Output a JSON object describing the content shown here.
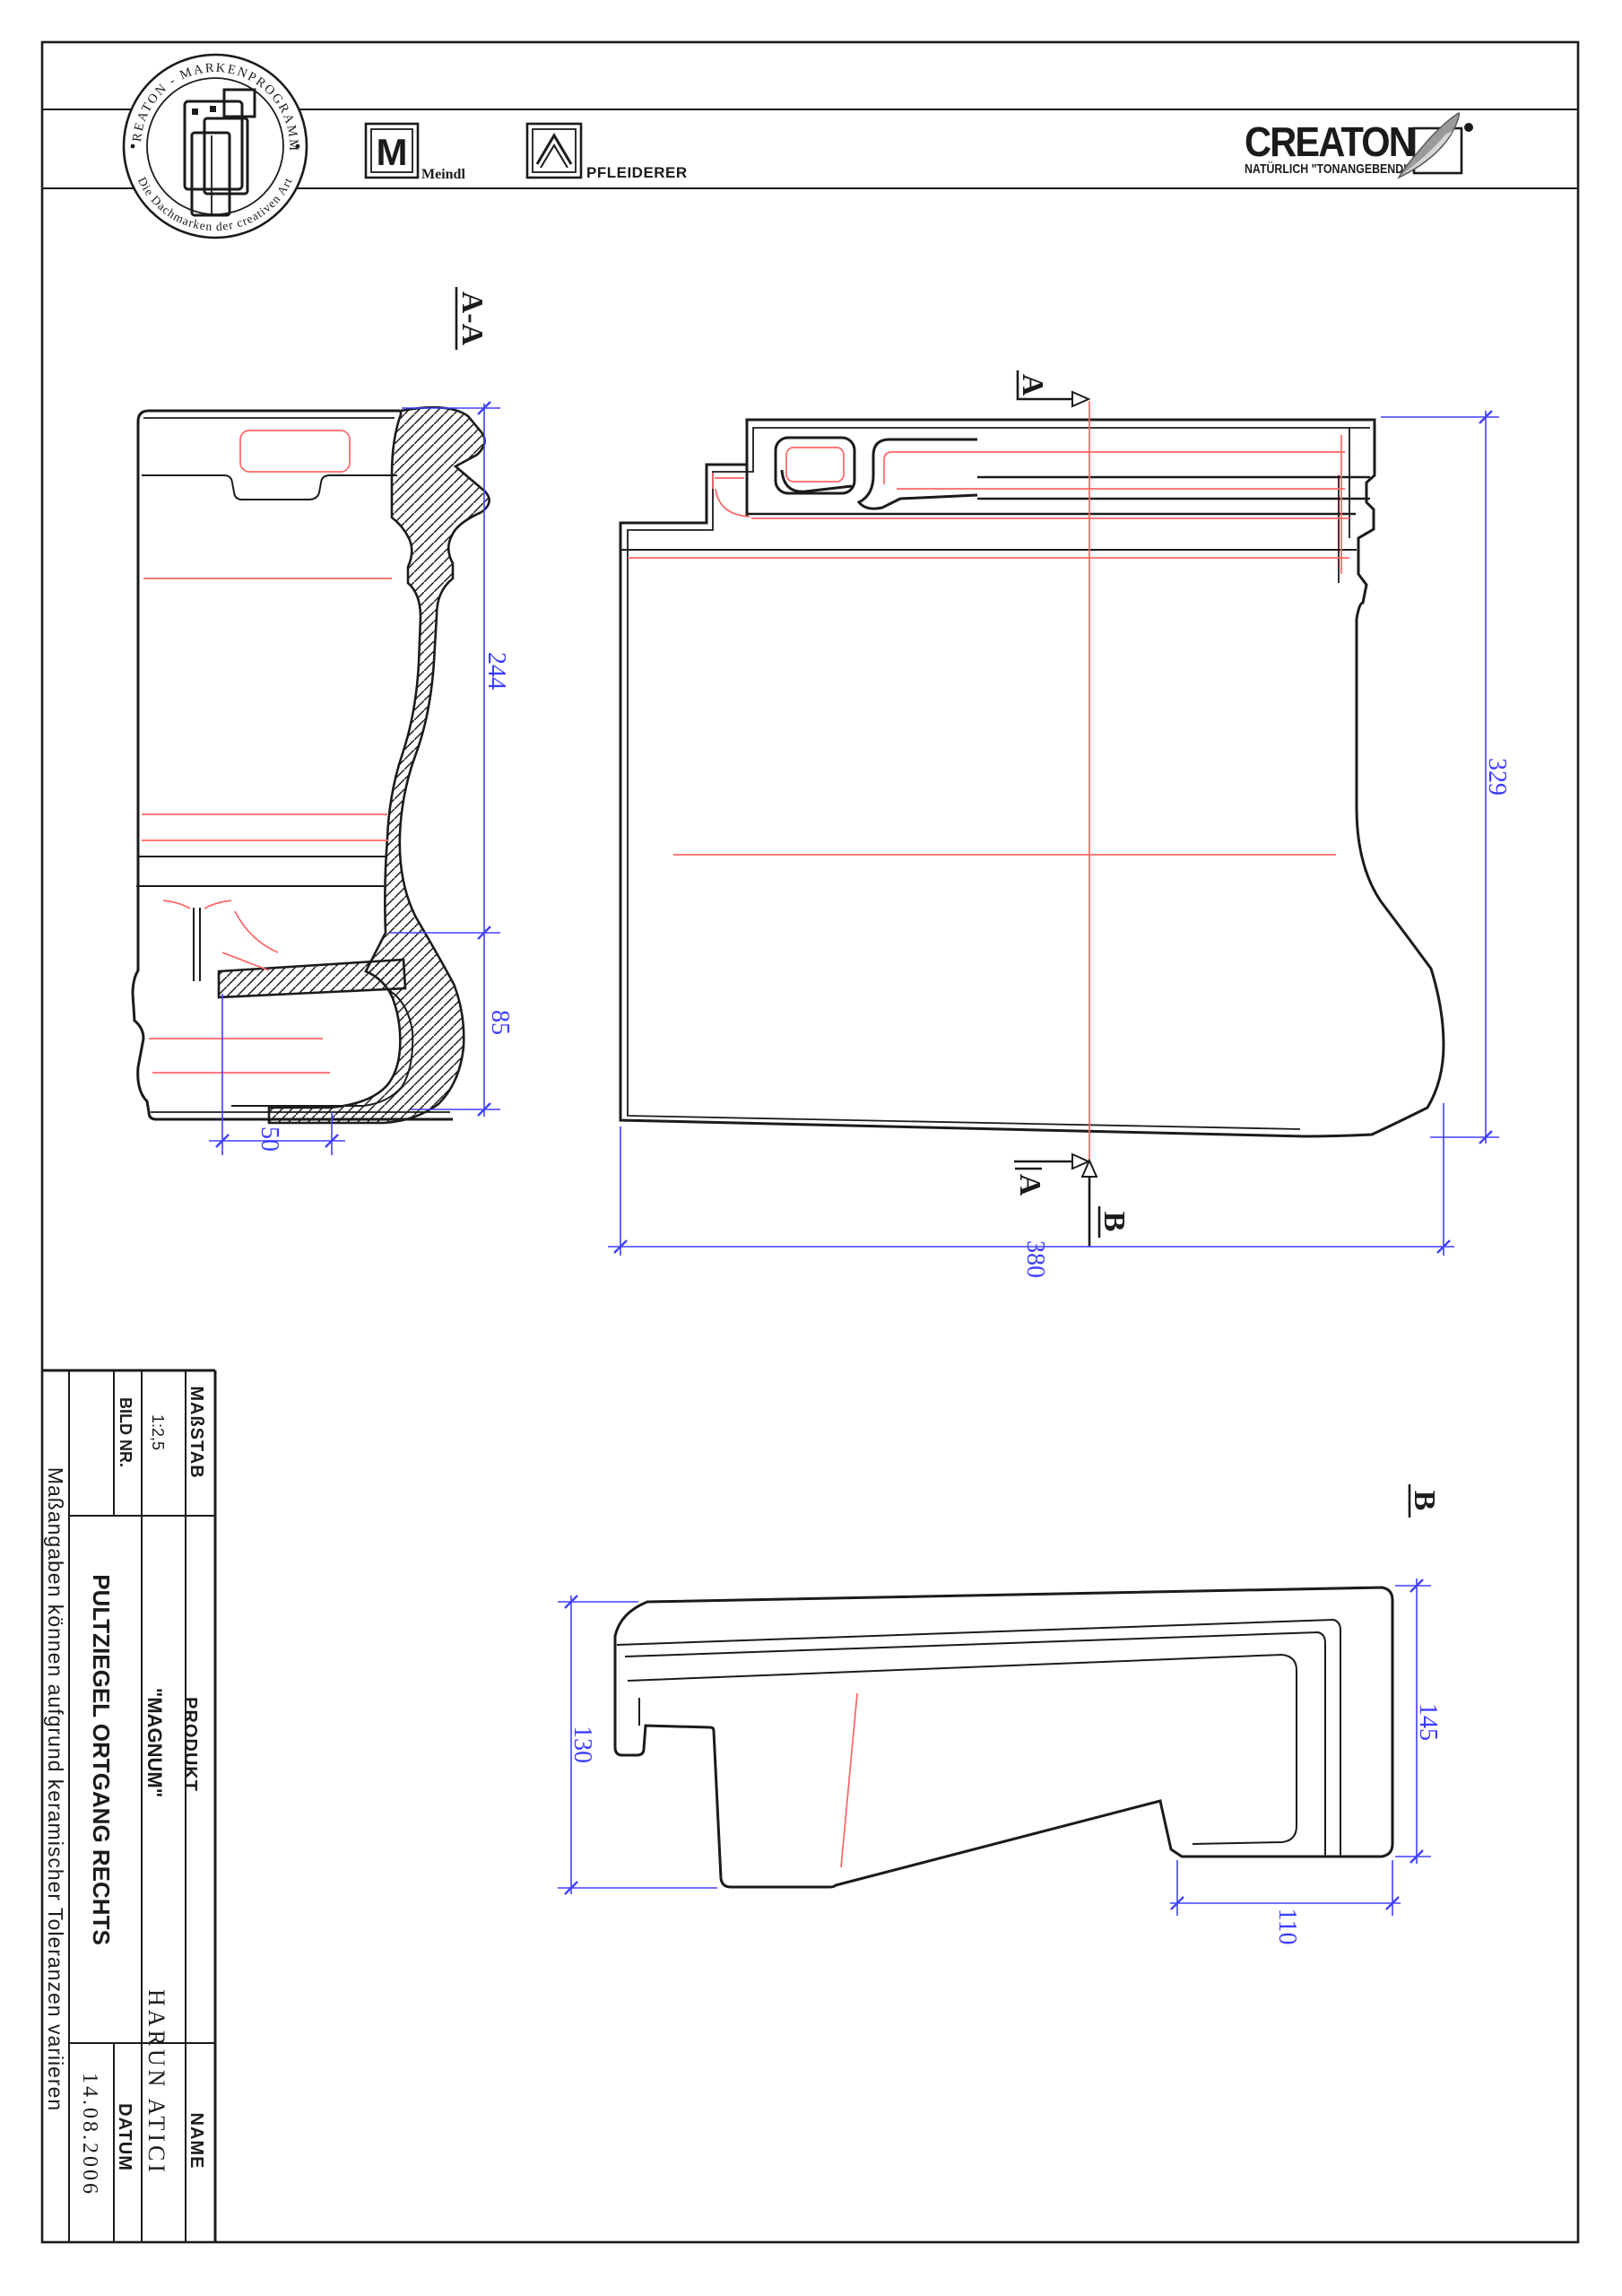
{
  "page": {
    "type": "technical-drawing-scan",
    "orientation_note": "drawing annotations rotated 90deg clockwise"
  },
  "logo_strip": {
    "stamp": {
      "ring_top": "CREATON - MARKENPROGRAMM",
      "ring_bottom": "Die Dachmarken der creativen Art"
    },
    "meindl": {
      "monogram": "M",
      "label": "Meindl"
    },
    "pfleiderer": {
      "label": "PFLEIDERER"
    },
    "creaton": {
      "wordmark": "CREATON",
      "tagline": "NATÜRLICH \"TONANGEBEND\""
    }
  },
  "sections": {
    "aa_label": "A-A",
    "a_label": "A",
    "b_label": "B"
  },
  "dimensions": {
    "aa_upper_height": "244",
    "aa_lower_height": "85",
    "aa_bottom_width": "50",
    "main_height": "329",
    "main_width": "380",
    "b_left_height": "130",
    "b_right_height": "145",
    "b_bottom_width": "110"
  },
  "title_block": {
    "massstab_label": "MAßSTAB",
    "massstab_value": "1:2,5",
    "bild_nr_label": "BILD NR.",
    "produkt_label": "PRODUKT",
    "produkt_value": "\"MAGNUM\"",
    "product_name": "PULTZIEGEL ORTGANG RECHTS",
    "name_label": "NAME",
    "name_value": "HARUN  ATICI",
    "datum_label": "DATUM",
    "datum_value": "14.08.2006",
    "disclaimer": "Maßangaben  können  aufgrund  keramischer  Toleranzen  variieren"
  },
  "colors": {
    "line": "#1b1b1b",
    "dimension_blue": "#3d3dff",
    "reference_red": "#ff6464"
  }
}
